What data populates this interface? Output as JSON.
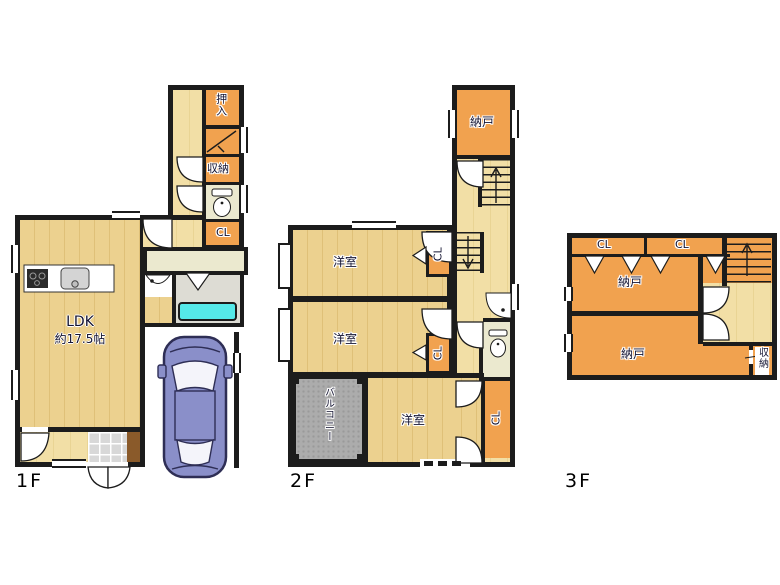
{
  "plan": {
    "type": "floor-plan",
    "floors": [
      {
        "id": "f1",
        "label": "1F"
      },
      {
        "id": "f2",
        "label": "2F"
      },
      {
        "id": "f3",
        "label": "3F"
      }
    ],
    "labels": {
      "ldk": "LDK",
      "ldk_size": "約17.5帖",
      "oshiire": "押入",
      "shuno": "収納",
      "cl": "CL",
      "nando": "納戸",
      "yoshitsu": "洋室",
      "balcony": "バルコニー"
    },
    "colors": {
      "wall": "#1c1c1c",
      "wood_floor": "#ecd18f",
      "hall_floor": "#f2dfa6",
      "storage_orange": "#f1a24f",
      "sanitary_cream": "#ebe9cf",
      "bathroom_gray": "#dddcd4",
      "bathtub_cyan": "#55e9e9",
      "balcony_gray": "#acacac",
      "entrance_tile": "#d8d8d8",
      "step_brown": "#8a5a2a",
      "car_body": "#8a8fc9"
    }
  }
}
